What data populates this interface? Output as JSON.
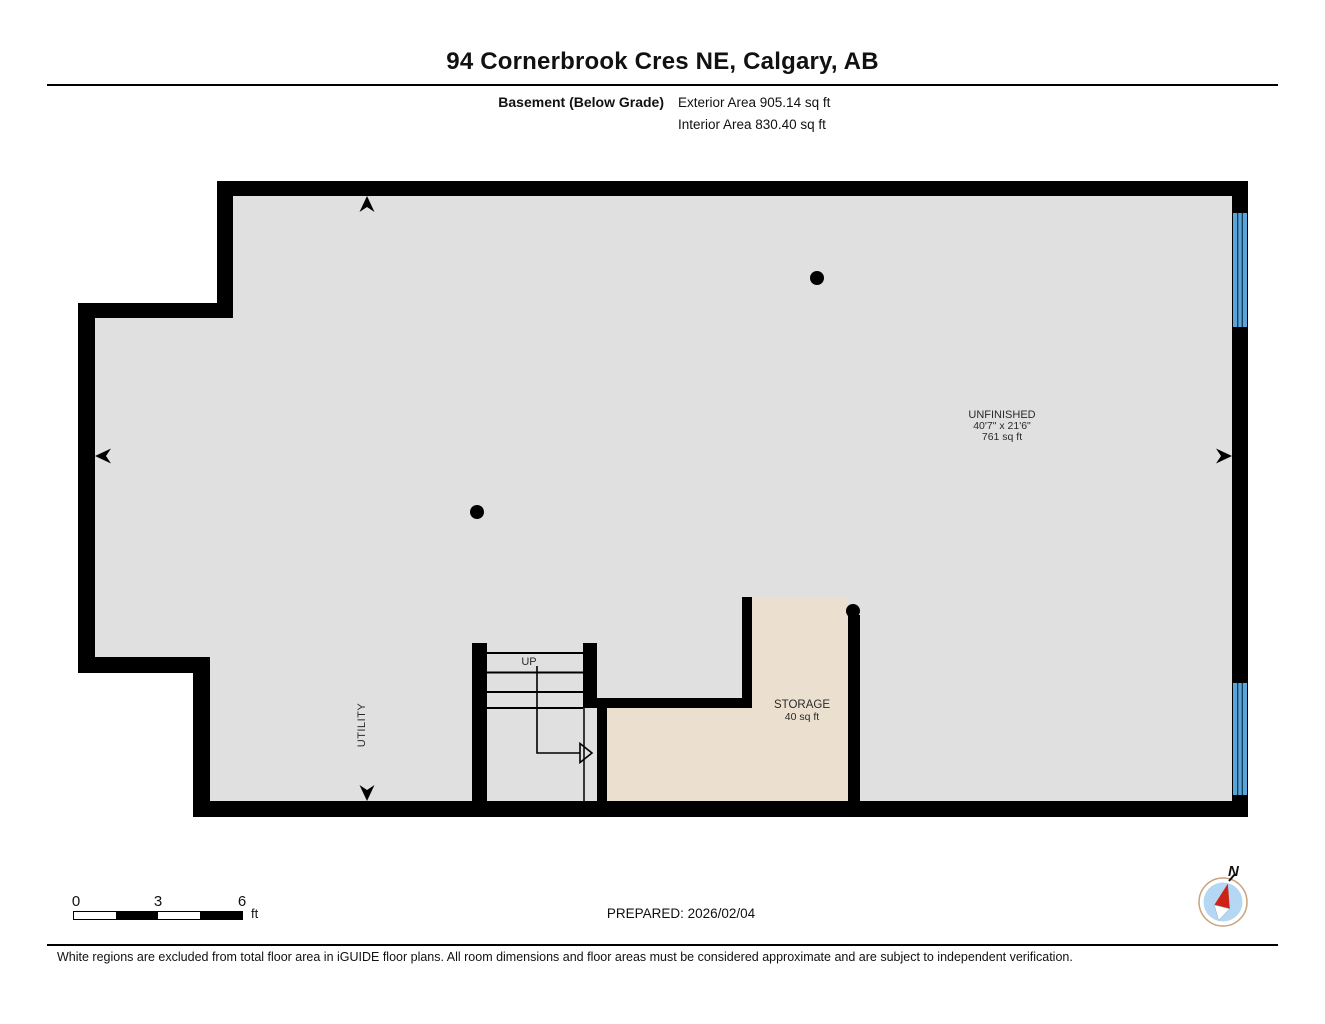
{
  "header": {
    "title": "94 Cornerbrook Cres NE, Calgary, AB",
    "floor_label": "Basement (Below Grade)",
    "exterior_area": "Exterior Area 905.14 sq ft",
    "interior_area": "Interior Area 830.40 sq ft"
  },
  "plan": {
    "rooms": [
      {
        "name": "UNFINISHED",
        "dimensions": "40'7\" x 21'6\"",
        "area": "761 sq ft"
      },
      {
        "name": "STORAGE",
        "area": "40 sq ft"
      },
      {
        "name": "UTILITY"
      }
    ],
    "stairs": {
      "label": "UP"
    }
  },
  "scale_bar": {
    "ticks": [
      "0",
      "3",
      "6"
    ],
    "unit": "ft"
  },
  "prepared": "PREPARED: 2026/02/04",
  "compass": {
    "north_label": "N"
  },
  "footer": "White regions are excluded from total floor area in iGUIDE floor plans. All room dimensions and floor areas must be considered approximate and are subject to independent verification.",
  "colors": {
    "wall": "#000000",
    "unfinished_floor": "#e0e0e0",
    "storage_floor": "#ebe0cf",
    "window_blue": "#5ba4d9",
    "compass_ring": "#c9a27e",
    "compass_fill": "#b4d8f3",
    "compass_needle_red": "#cc2418"
  }
}
